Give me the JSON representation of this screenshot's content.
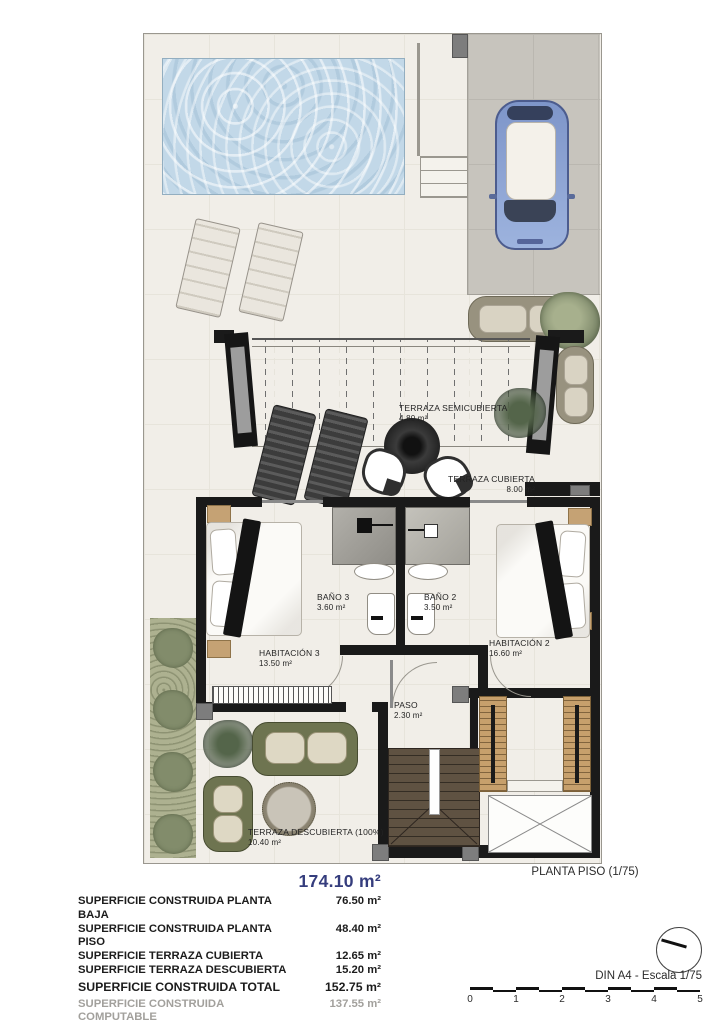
{
  "plan": {
    "caption": "PLANTA PISO (1/75)",
    "rooms": [
      {
        "id": "terraza-semicubierta",
        "label": "TERRAZA SEMICUBIERTA",
        "area": "4.80 m²"
      },
      {
        "id": "terraza-cubierta",
        "label": "TERRAZA CUBIERTA",
        "area": "8.00 m²"
      },
      {
        "id": "bano-3",
        "label": "BAÑO 3",
        "area": "3.60 m²"
      },
      {
        "id": "bano-2",
        "label": "BAÑO 2",
        "area": "3.50 m²"
      },
      {
        "id": "habitacion-3",
        "label": "HABITACIÓN 3",
        "area": "13.50 m²"
      },
      {
        "id": "habitacion-2",
        "label": "HABITACIÓN 2",
        "area": "16.60 m²"
      },
      {
        "id": "paso",
        "label": "PASO",
        "area": "2.30 m²"
      },
      {
        "id": "terraza-descubierta",
        "label": "TERRAZA DESCUBIERTA (100%)",
        "area": "10.40 m²"
      }
    ]
  },
  "summary": {
    "total_title": "174.10 m²",
    "rows": [
      {
        "label": "SUPERFICIE CONSTRUIDA PLANTA BAJA",
        "value": "76.50 m²"
      },
      {
        "label": "SUPERFICIE CONSTRUIDA PLANTA PISO",
        "value": "48.40 m²"
      },
      {
        "label": "SUPERFICIE TERRAZA CUBIERTA",
        "value": "12.65 m²"
      },
      {
        "label": "SUPERFICIE TERRAZA DESCUBIERTA",
        "value": "15.20 m²"
      }
    ],
    "total_row": {
      "label": "SUPERFICIE CONSTRUIDA TOTAL",
      "value": "152.75 m²"
    },
    "computable_row": {
      "label": "SUPERFICIE CONSTRUIDA COMPUTABLE",
      "value": "137.55 m²"
    }
  },
  "footer": {
    "scale_label": "DIN A4 - Escala 1/75",
    "scale_ticks": [
      "0",
      "1",
      "2",
      "3",
      "4",
      "5"
    ]
  },
  "colors": {
    "title_navy": "#353d7d",
    "wall_black": "#1a1a1a",
    "pool_blue": "#c2d8e8",
    "driveway_gray": "#c7c4bd",
    "floor_ivory": "#f1eee8",
    "stair_wood_dark": "#5f5242",
    "wardrobe_wood_light": "#c7a06c",
    "sofa_olive": "#6e7450",
    "garden_green": "#adb190",
    "car_blue": "#8ba1d4"
  }
}
